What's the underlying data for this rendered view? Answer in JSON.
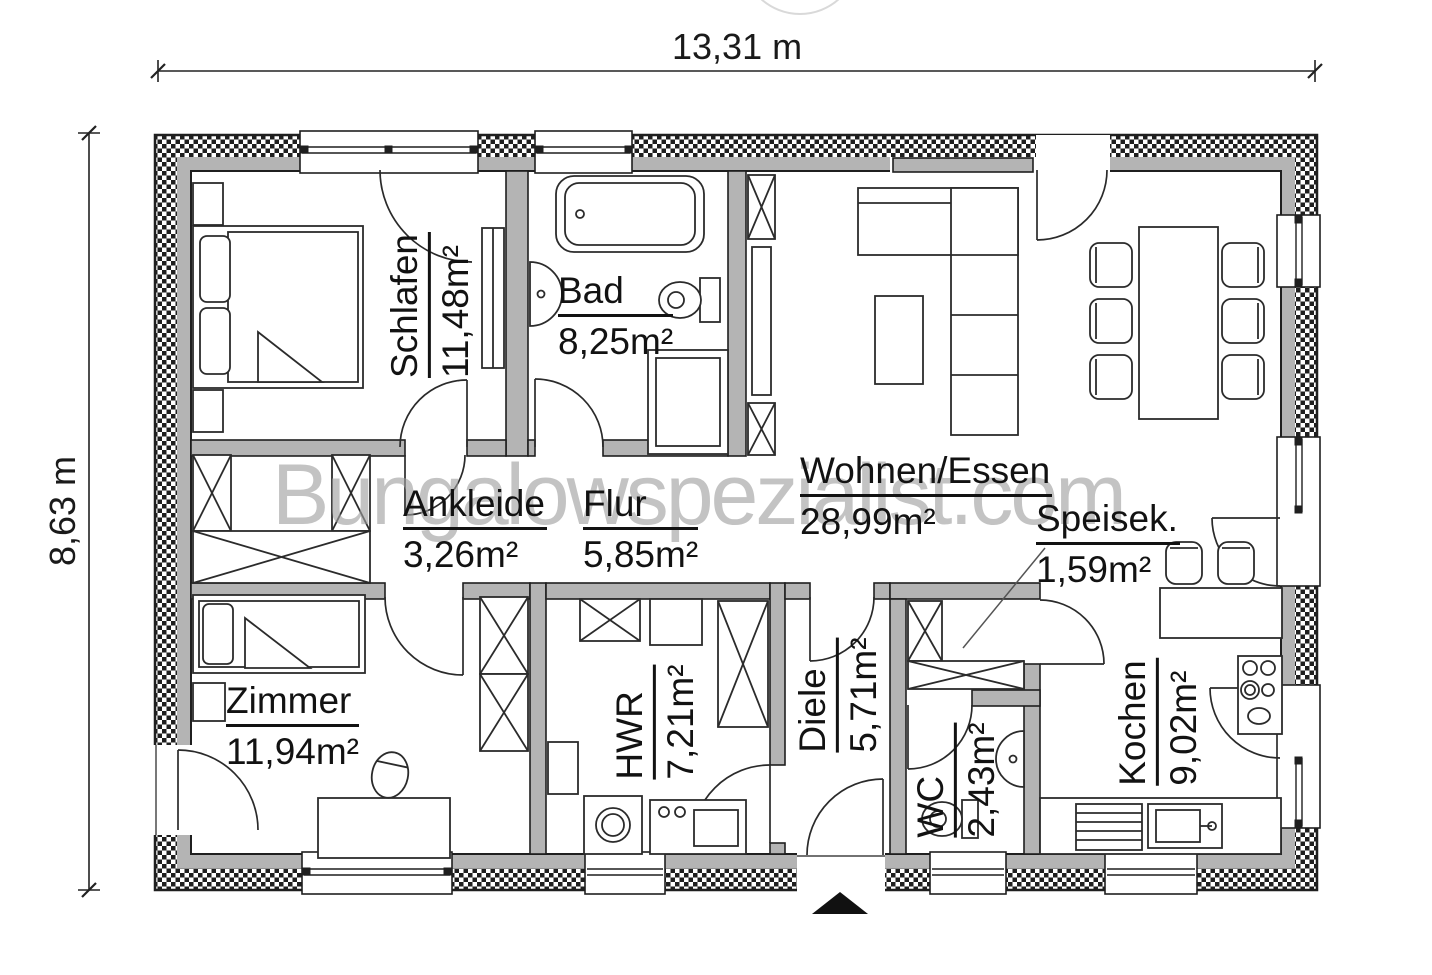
{
  "title": "Bungalow Grundriss",
  "dims": {
    "width": "13,31 m",
    "height": "8,63 m"
  },
  "watermark": {
    "text": "Bungalowspezialist.com"
  },
  "rooms": [
    {
      "id": "schlafen",
      "name": "Schlafen",
      "area": "11,48m²"
    },
    {
      "id": "bad",
      "name": "Bad",
      "area": "8,25m²"
    },
    {
      "id": "wohnen",
      "name": "Wohnen/Essen",
      "area": "28,99m²"
    },
    {
      "id": "ankleide",
      "name": "Ankleide",
      "area": "3,26m²"
    },
    {
      "id": "flur",
      "name": "Flur",
      "area": "5,85m²"
    },
    {
      "id": "speisek",
      "name": "Speisek.",
      "area": "1,59m²"
    },
    {
      "id": "zimmer",
      "name": "Zimmer",
      "area": "11,94m²"
    },
    {
      "id": "hwr",
      "name": "HWR",
      "area": "7,21m²"
    },
    {
      "id": "diele",
      "name": "Diele",
      "area": "5,71m²"
    },
    {
      "id": "wc",
      "name": "WC",
      "area": "2,43m²"
    },
    {
      "id": "kochen",
      "name": "Kochen",
      "area": "9,02m²"
    }
  ],
  "colors": {
    "wall_gray": "#b4b4b4",
    "line": "#1f1f1f",
    "watermark_gray": "#9f9f9f"
  }
}
